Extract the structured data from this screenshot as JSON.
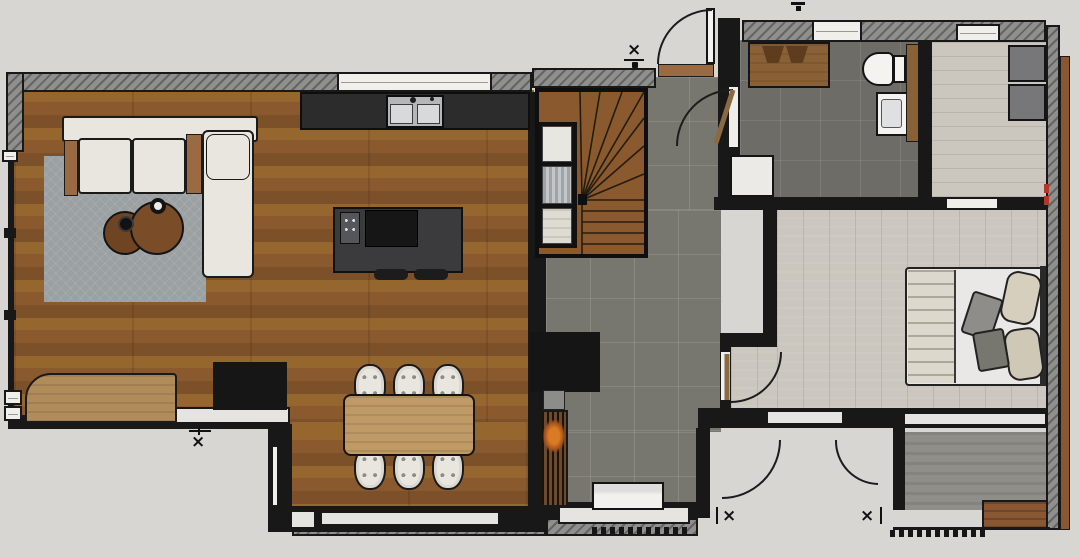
{
  "plan": {
    "kind": "residential-floor-plan",
    "markers": {
      "symbol": "×"
    },
    "colors": {
      "bg": "#d8d6d3",
      "wall": "#181818",
      "hatch": "#8f8f8d",
      "wood-a": "#96662f",
      "wood-b": "#8a5a2e",
      "wood-c": "#7c5129",
      "tile": "#78776f",
      "tile-dark": "#6d6c66",
      "plank": "#cbc7bf",
      "rug": "#9ba0a3",
      "island": "#3b3b3d",
      "counter": "#2c2c2d",
      "steel": "#b5b6b7",
      "cream": "#e9e6df",
      "wood-trim": "#9a6b43",
      "table-wood": "#c09a66",
      "desk-wood": "#b08c5a",
      "door-leaf": "#8a6a42",
      "fire": "#d97b24",
      "slats": "#6b4a2e",
      "deck": "#8a5733",
      "terrace": "#908e89",
      "window": "#f1efec",
      "sill": "#e6e4e0",
      "wardrobe": "#77777a",
      "radiator": "#f2f1ee",
      "red-tick": "#b03a2a"
    }
  }
}
